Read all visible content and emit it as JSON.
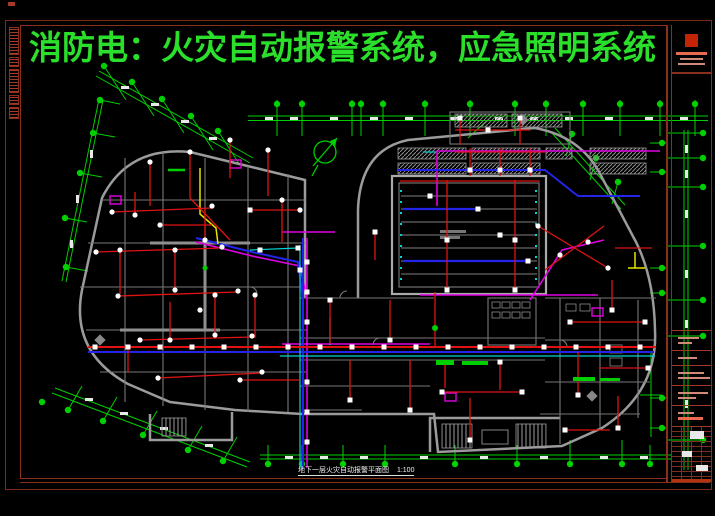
{
  "sheet": {
    "title": "消防电：火灾自动报警系统，应急照明系统",
    "drawing_name": "地下一层火灾自动报警平面图",
    "drawing_scale": "1:100"
  },
  "legend_colors": {
    "axis_green": "#00cf00",
    "title_green": "#2ae02a",
    "wire_red": "#e01212",
    "wire_blue": "#2424e8",
    "wire_magenta": "#e000e0",
    "wire_cyan": "#00d4d4",
    "wire_yellow": "#e6e600",
    "wall_gray": "#9b9b9b",
    "device_white": "#ffffff",
    "frame_red": "#8a2f1b"
  },
  "icons": {
    "north_arrow": "north-arrow-icon: green circle with slash and arrow",
    "axis_bubble": "axis-bubble-icon: filled green circle on grid tick",
    "smoke_detector": "smoke-detector-icon: small white circle on wire",
    "alarm_device": "alarm-device-icon: small white square on wire",
    "manual_call_point": "manual-call-point-icon: magenta box",
    "company_logo": "red-square-logo in title block"
  },
  "plan": {
    "axis_bubbles": [
      [
        277,
        104
      ],
      [
        302,
        104
      ],
      [
        352,
        104
      ],
      [
        361,
        104
      ],
      [
        383,
        104
      ],
      [
        425,
        104
      ],
      [
        470,
        104
      ],
      [
        515,
        104
      ],
      [
        546,
        104
      ],
      [
        583,
        104
      ],
      [
        620,
        104
      ],
      [
        660,
        104
      ],
      [
        695,
        104
      ],
      [
        703,
        133
      ],
      [
        703,
        158
      ],
      [
        703,
        187
      ],
      [
        703,
        246
      ],
      [
        703,
        300
      ],
      [
        703,
        336
      ],
      [
        703,
        440
      ],
      [
        662,
        143
      ],
      [
        662,
        172
      ],
      [
        662,
        268
      ],
      [
        662,
        293
      ],
      [
        662,
        398
      ],
      [
        662,
        428
      ],
      [
        268,
        464
      ],
      [
        302,
        464
      ],
      [
        343,
        464
      ],
      [
        385,
        464
      ],
      [
        455,
        464
      ],
      [
        517,
        464
      ],
      [
        570,
        464
      ],
      [
        622,
        464
      ],
      [
        650,
        464
      ],
      [
        104,
        66
      ],
      [
        132,
        82
      ],
      [
        162,
        99
      ],
      [
        191,
        116
      ],
      [
        218,
        131
      ],
      [
        100,
        100
      ],
      [
        93,
        133
      ],
      [
        80,
        173
      ],
      [
        65,
        218
      ],
      [
        66,
        267
      ],
      [
        42,
        402
      ],
      [
        68,
        410
      ],
      [
        103,
        421
      ],
      [
        143,
        435
      ],
      [
        188,
        450
      ],
      [
        223,
        461
      ],
      [
        572,
        134
      ],
      [
        596,
        158
      ],
      [
        618,
        182
      ]
    ],
    "detector_squares": [
      [
        95,
        347
      ],
      [
        128,
        347
      ],
      [
        160,
        347
      ],
      [
        192,
        347
      ],
      [
        224,
        347
      ],
      [
        256,
        347
      ],
      [
        288,
        347
      ],
      [
        320,
        347
      ],
      [
        352,
        347
      ],
      [
        384,
        347
      ],
      [
        416,
        347
      ],
      [
        448,
        347
      ],
      [
        480,
        347
      ],
      [
        512,
        347
      ],
      [
        544,
        347
      ],
      [
        576,
        347
      ],
      [
        608,
        347
      ],
      [
        640,
        347
      ],
      [
        307,
        262
      ],
      [
        307,
        292
      ],
      [
        307,
        322
      ],
      [
        307,
        382
      ],
      [
        307,
        412
      ],
      [
        307,
        442
      ],
      [
        470,
        170
      ],
      [
        500,
        170
      ],
      [
        530,
        170
      ],
      [
        447,
        240
      ],
      [
        515,
        240
      ],
      [
        447,
        290
      ],
      [
        515,
        290
      ],
      [
        478,
        209
      ],
      [
        528,
        261
      ],
      [
        430,
        196
      ],
      [
        500,
        235
      ],
      [
        570,
        322
      ],
      [
        645,
        322
      ],
      [
        578,
        395
      ],
      [
        648,
        368
      ],
      [
        618,
        428
      ],
      [
        565,
        430
      ],
      [
        612,
        310
      ],
      [
        470,
        440
      ],
      [
        442,
        392
      ],
      [
        522,
        392
      ],
      [
        500,
        362
      ],
      [
        330,
        300
      ],
      [
        350,
        400
      ],
      [
        390,
        340
      ],
      [
        410,
        410
      ],
      [
        375,
        232
      ],
      [
        460,
        118
      ],
      [
        520,
        118
      ],
      [
        488,
        130
      ],
      [
        250,
        210
      ],
      [
        298,
        248
      ],
      [
        260,
        250
      ],
      [
        300,
        270
      ]
    ],
    "detector_circles": [
      [
        112,
        212
      ],
      [
        96,
        252
      ],
      [
        118,
        296
      ],
      [
        140,
        340
      ],
      [
        158,
        378
      ],
      [
        150,
        162
      ],
      [
        190,
        152
      ],
      [
        230,
        140
      ],
      [
        268,
        150
      ],
      [
        212,
        206
      ],
      [
        222,
        247
      ],
      [
        238,
        291
      ],
      [
        252,
        336
      ],
      [
        262,
        372
      ],
      [
        175,
        250
      ],
      [
        120,
        250
      ],
      [
        215,
        295
      ],
      [
        255,
        295
      ],
      [
        170,
        340
      ],
      [
        205,
        240
      ],
      [
        282,
        200
      ],
      [
        300,
        210
      ],
      [
        135,
        215
      ],
      [
        175,
        290
      ],
      [
        215,
        335
      ],
      [
        240,
        380
      ],
      [
        200,
        310
      ],
      [
        160,
        225
      ],
      [
        538,
        226
      ],
      [
        608,
        268
      ],
      [
        560,
        255
      ],
      [
        588,
        242
      ]
    ]
  }
}
